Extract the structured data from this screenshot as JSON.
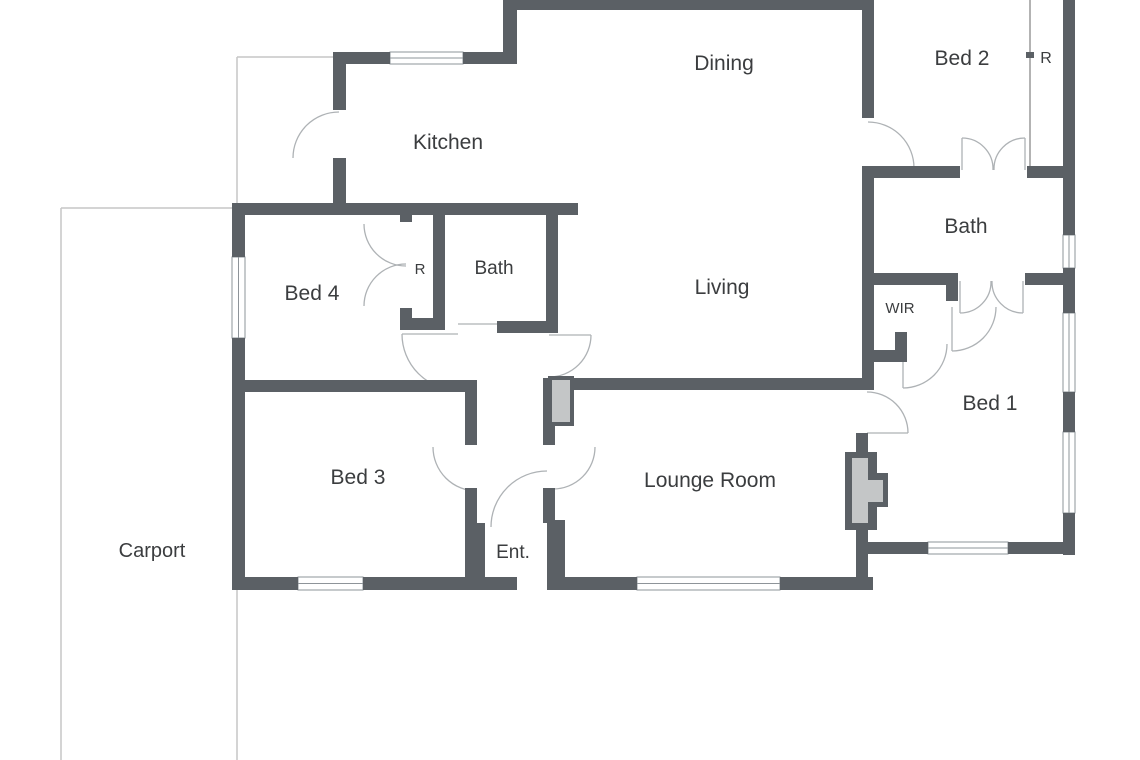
{
  "plan": {
    "title": "Single storey floor plan",
    "canvas": {
      "width": 1140,
      "height": 760,
      "background": "#ffffff"
    },
    "colors": {
      "wall": "#5b6065",
      "window_frame": "#8e9499",
      "window_fill": "#ffffff",
      "door_arc": "#aeb2b5",
      "boundary_line": "#c6c6c6",
      "slider_line": "#9a9a9a",
      "fixture_fill": "#c4c6c7",
      "label": "#3b3d3f"
    },
    "rooms": [
      {
        "id": "kitchen",
        "label": "Kitchen",
        "x": 448,
        "y": 149,
        "font_size": 21
      },
      {
        "id": "dining",
        "label": "Dining",
        "x": 724,
        "y": 70,
        "font_size": 21
      },
      {
        "id": "bed-2",
        "label": "Bed 2",
        "x": 962,
        "y": 65,
        "font_size": 21
      },
      {
        "id": "robe-bed-2",
        "label": "R",
        "x": 1046,
        "y": 63,
        "font_size": 16
      },
      {
        "id": "bed-4",
        "label": "Bed 4",
        "x": 312,
        "y": 300,
        "font_size": 21
      },
      {
        "id": "robe-bed-4",
        "label": "R",
        "x": 420,
        "y": 274,
        "font_size": 15
      },
      {
        "id": "bath-left",
        "label": "Bath",
        "x": 494,
        "y": 274,
        "font_size": 19
      },
      {
        "id": "living",
        "label": "Living",
        "x": 722,
        "y": 294,
        "font_size": 21
      },
      {
        "id": "bath-right",
        "label": "Bath",
        "x": 966,
        "y": 233,
        "font_size": 21
      },
      {
        "id": "wir",
        "label": "WIR",
        "x": 900,
        "y": 313,
        "font_size": 15
      },
      {
        "id": "bed-3",
        "label": "Bed 3",
        "x": 358,
        "y": 484,
        "font_size": 21
      },
      {
        "id": "lounge-room",
        "label": "Lounge Room",
        "x": 710,
        "y": 487,
        "font_size": 21
      },
      {
        "id": "bed-1",
        "label": "Bed 1",
        "x": 990,
        "y": 410,
        "font_size": 21
      },
      {
        "id": "entry",
        "label": "Ent.",
        "x": 513,
        "y": 558,
        "font_size": 19
      },
      {
        "id": "carport",
        "label": "Carport",
        "x": 152,
        "y": 557,
        "font_size": 20
      }
    ],
    "walls": [
      [
        517,
        0,
        345,
        10
      ],
      [
        503,
        0,
        14,
        64
      ],
      [
        333,
        52,
        57,
        12
      ],
      [
        463,
        52,
        54,
        12
      ],
      [
        333,
        52,
        13,
        58
      ],
      [
        333,
        158,
        13,
        57
      ],
      [
        232,
        203,
        346,
        12
      ],
      [
        232,
        203,
        13,
        54
      ],
      [
        232,
        338,
        13,
        252
      ],
      [
        245,
        380,
        232,
        12
      ],
      [
        465,
        380,
        12,
        65
      ],
      [
        465,
        488,
        12,
        35
      ],
      [
        465,
        523,
        20,
        54
      ],
      [
        232,
        577,
        66,
        13
      ],
      [
        363,
        577,
        154,
        13
      ],
      [
        547,
        577,
        90,
        13
      ],
      [
        780,
        577,
        93,
        13
      ],
      [
        543,
        380,
        12,
        65
      ],
      [
        543,
        488,
        12,
        35
      ],
      [
        547,
        520,
        18,
        57
      ],
      [
        543,
        378,
        325,
        12
      ],
      [
        862,
        0,
        12,
        118
      ],
      [
        862,
        166,
        12,
        224
      ],
      [
        856,
        433,
        12,
        19
      ],
      [
        856,
        530,
        12,
        60
      ],
      [
        874,
        166,
        86,
        12
      ],
      [
        1027,
        166,
        36,
        12
      ],
      [
        874,
        273,
        72,
        12
      ],
      [
        946,
        273,
        12,
        28
      ],
      [
        1025,
        273,
        38,
        12
      ],
      [
        874,
        350,
        33,
        12
      ],
      [
        895,
        332,
        12,
        18
      ],
      [
        1063,
        0,
        12,
        235
      ],
      [
        1063,
        268,
        12,
        45
      ],
      [
        1063,
        392,
        12,
        40
      ],
      [
        1063,
        513,
        12,
        42
      ],
      [
        868,
        542,
        60,
        12
      ],
      [
        1008,
        542,
        55,
        12
      ],
      [
        400,
        203,
        12,
        19
      ],
      [
        400,
        308,
        12,
        22
      ],
      [
        433,
        203,
        12,
        127
      ],
      [
        400,
        318,
        45,
        12
      ],
      [
        546,
        203,
        12,
        130
      ],
      [
        497,
        321,
        49,
        12
      ],
      [
        1026,
        52,
        8,
        6
      ]
    ],
    "windows": [
      [
        390,
        52,
        73,
        12
      ],
      [
        232,
        257,
        13,
        81
      ],
      [
        298,
        577,
        65,
        13
      ],
      [
        637,
        577,
        143,
        13
      ],
      [
        1063,
        235,
        12,
        33
      ],
      [
        1063,
        313,
        12,
        79
      ],
      [
        1063,
        432,
        12,
        81
      ],
      [
        928,
        542,
        80,
        12
      ]
    ],
    "fixtures": {
      "outer": [
        [
          845,
          452,
          32,
          78
        ],
        [
          877,
          473,
          11,
          34
        ],
        [
          548,
          376,
          26,
          50
        ]
      ],
      "inner": [
        [
          852,
          458,
          16,
          65
        ],
        [
          868,
          480,
          15,
          22
        ],
        [
          552,
          380,
          18,
          42
        ]
      ]
    },
    "boundary_lines": [
      [
        237,
        57,
        237,
        760
      ],
      [
        61,
        208,
        61,
        760
      ],
      [
        237,
        57,
        333,
        57
      ],
      [
        61,
        208,
        232,
        208
      ]
    ],
    "slider_lines": [
      [
        1030,
        0,
        1030,
        166
      ]
    ],
    "door_arcs": [
      "M339,112 A46,46 0 0 0 293,158",
      "M868,122 A46,46 0 0 1 914,168",
      "M867,392 A41,41 0 0 1 908,433",
      "M433,447 A44,44 0 0 0 477,491",
      "M595,447 A42,42 0 0 1 553,489",
      "M491,527 A56,56 0 0 1 547,471",
      "M402,334 A56,56 0 0 0 458,390",
      "M591,335 A42,42 0 0 1 549,377",
      "M406,266 A42,42 0 0 1 364,224",
      "M364,306 A42,42 0 0 1 406,264",
      "M962,138 A31,31 0 0 1 993,170",
      "M1025,138 A31,31 0 0 0 994,170",
      "M960,313 A31,31 0 0 0 991,281",
      "M1023,313 A31,31 0 0 1 992,281",
      "M952,351 A44,44 0 0 0 996,307",
      "M903,388 A44,44 0 0 0 947,344"
    ],
    "door_leaves": [
      [
        867,
        433,
        908,
        433
      ],
      [
        402,
        334,
        458,
        334
      ],
      [
        549,
        335,
        591,
        335
      ],
      [
        458,
        324,
        497,
        324
      ],
      [
        962,
        170,
        962,
        138
      ],
      [
        1025,
        170,
        1025,
        138
      ],
      [
        960,
        281,
        960,
        313
      ],
      [
        1023,
        281,
        1023,
        313
      ],
      [
        952,
        307,
        952,
        351
      ],
      [
        903,
        344,
        903,
        388
      ]
    ]
  }
}
